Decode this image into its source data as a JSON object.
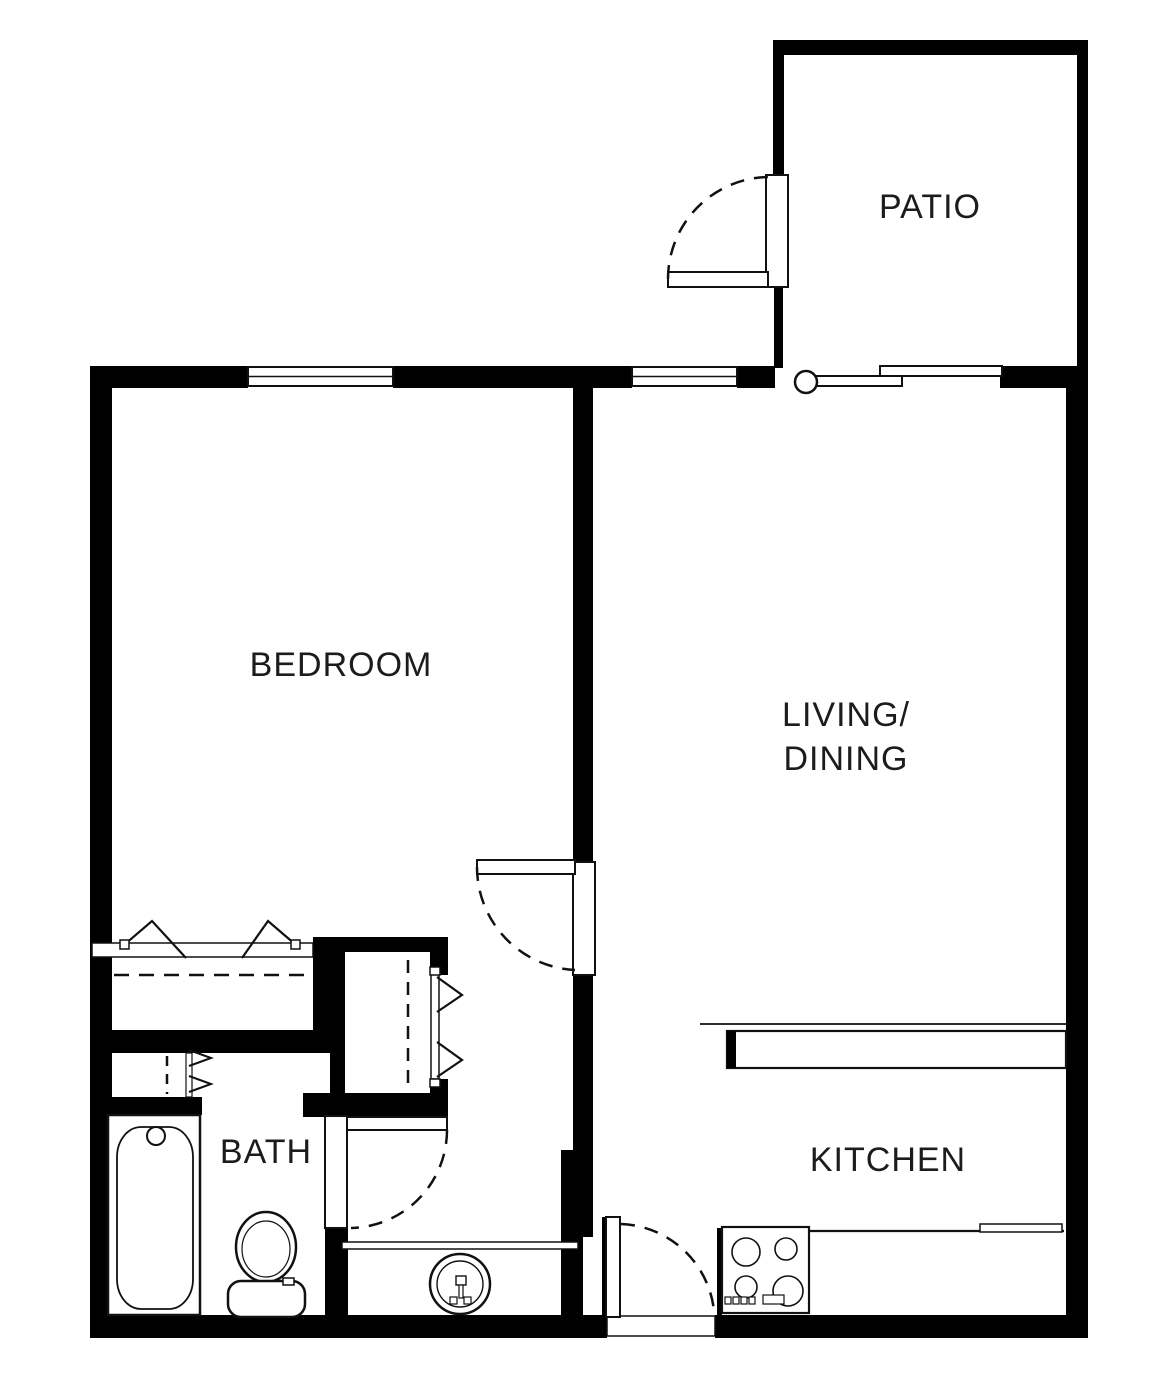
{
  "document": {
    "type": "apartment-floor-plan",
    "description": "One-bedroom one-bath apartment floor plan with patio"
  },
  "colors": {
    "walls": "#000000",
    "background": "#ffffff",
    "linework": "#1a1a1a"
  },
  "rooms": {
    "patio": {
      "label": "PATIO"
    },
    "bedroom": {
      "label": "BEDROOM"
    },
    "living_dining": {
      "label_line1": "LIVING/",
      "label_line2": "DINING"
    },
    "bath": {
      "label": "BATH"
    },
    "kitchen": {
      "label": "KITCHEN"
    }
  },
  "fixtures": [
    "bathtub",
    "toilet",
    "vanity-sink",
    "range-cooktop",
    "breakfast-bar-counter",
    "kitchen-counter",
    "bedroom-closet-bifold",
    "hall-closet-bifold",
    "linen-closet-bifold",
    "sliding-patio-door",
    "patio-swing-door",
    "bedroom-swing-door",
    "bath-swing-door",
    "entry-swing-door",
    "window",
    "window"
  ]
}
